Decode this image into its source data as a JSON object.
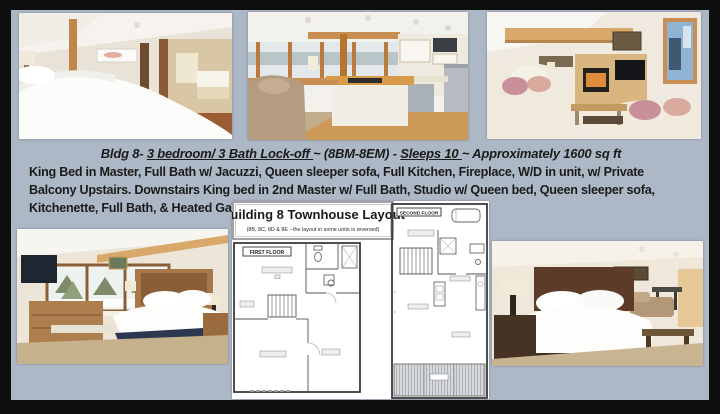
{
  "page": {
    "background_color": "#adb8c6",
    "frame_color": "#0e0e0e",
    "text_color": "#1b1b1b"
  },
  "headline": {
    "part1": "Bldg 8- ",
    "part2_underlined": "3 bedroom/ 3 Bath Lock-off ",
    "part3": "~ (8BM-8EM) - ",
    "part4_underlined": "Sleeps 10 ",
    "part5": " ~ Approximately 1600 sq ft"
  },
  "description": "King Bed in Master, Full Bath w/ Jacuzzi, Queen sleeper sofa, Full Kitchen, Fireplace, W/D in unit, w/ Private Balcony Upstairs. Downstairs King bed in 2nd Master w/ Full Bath, Studio w/ Queen bed, Queen sleeper sofa, Kitchenette, Full Bath, & Heated Garage.",
  "floorplan": {
    "title": "Building 8 Townhouse Layout",
    "subtitle": "(8B, 8C, 8D & 8E --the layout in some units is reversed)",
    "first_floor_label": "FIRST FLOOR",
    "second_floor_label": "SECOND FLOOR"
  },
  "photos": {
    "top_left": "master-bedroom-with-ensuite-bath",
    "top_middle": "full-kitchen-with-island",
    "top_right": "living-room-with-fireplace-and-tv",
    "bottom_left": "second-master-king-bedroom",
    "bottom_right": "studio-with-queen-bed"
  }
}
